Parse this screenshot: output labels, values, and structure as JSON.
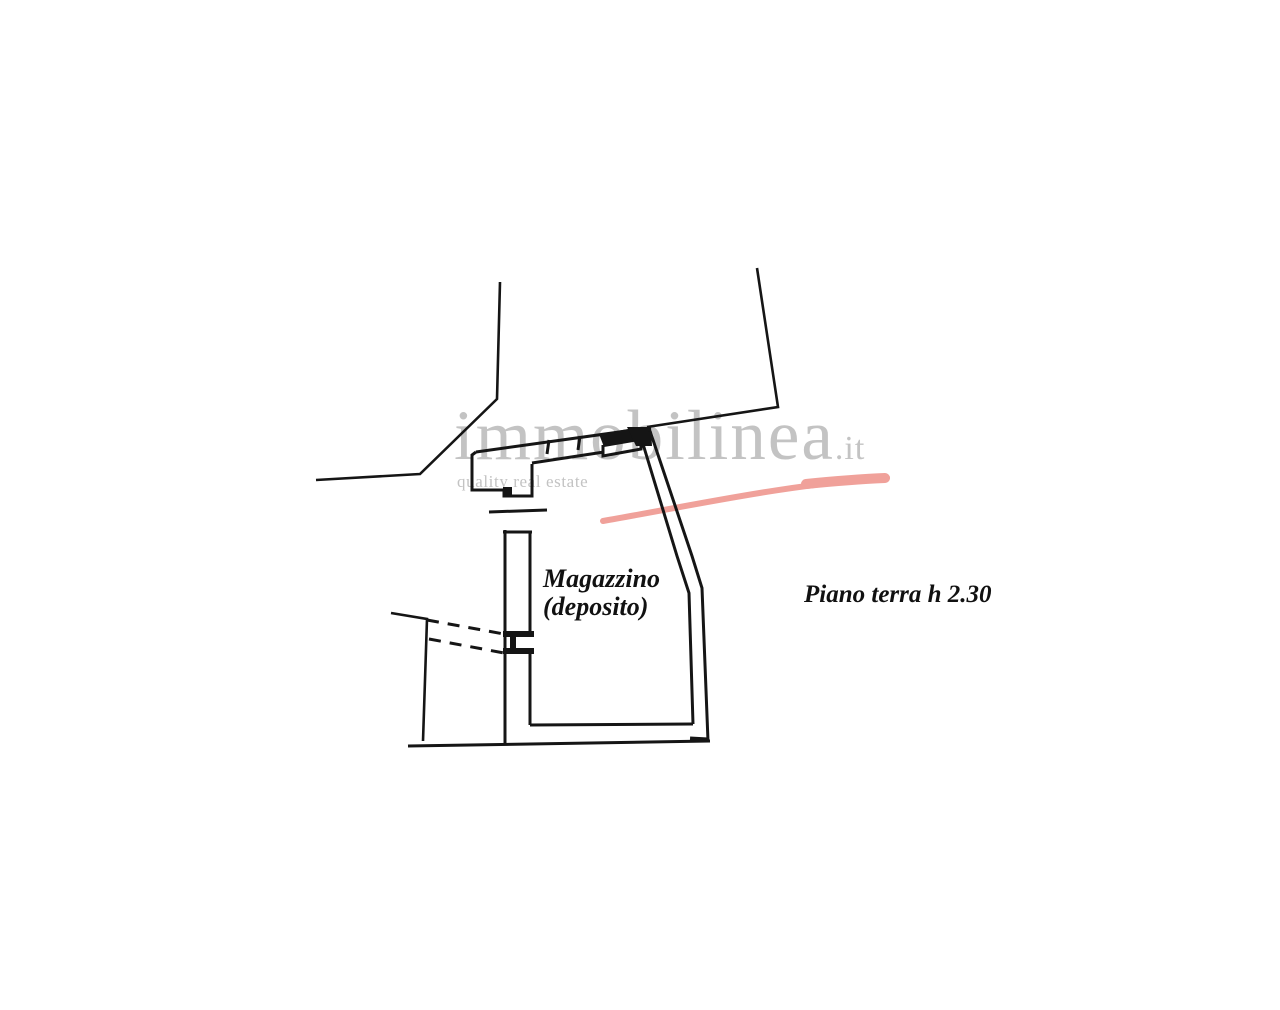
{
  "page": {
    "background_color": "#ffffff"
  },
  "watermark": {
    "brand": "immobilinea",
    "tld": ".it",
    "tagline": "quality real estate",
    "text_color": "#c3c3c3",
    "swoosh_color": "#f0a19a"
  },
  "plan": {
    "line_color": "#151515",
    "room": {
      "name": "Magazzino",
      "qualifier": "(deposito)"
    },
    "floor_note": "Piano terra h 2.30"
  }
}
